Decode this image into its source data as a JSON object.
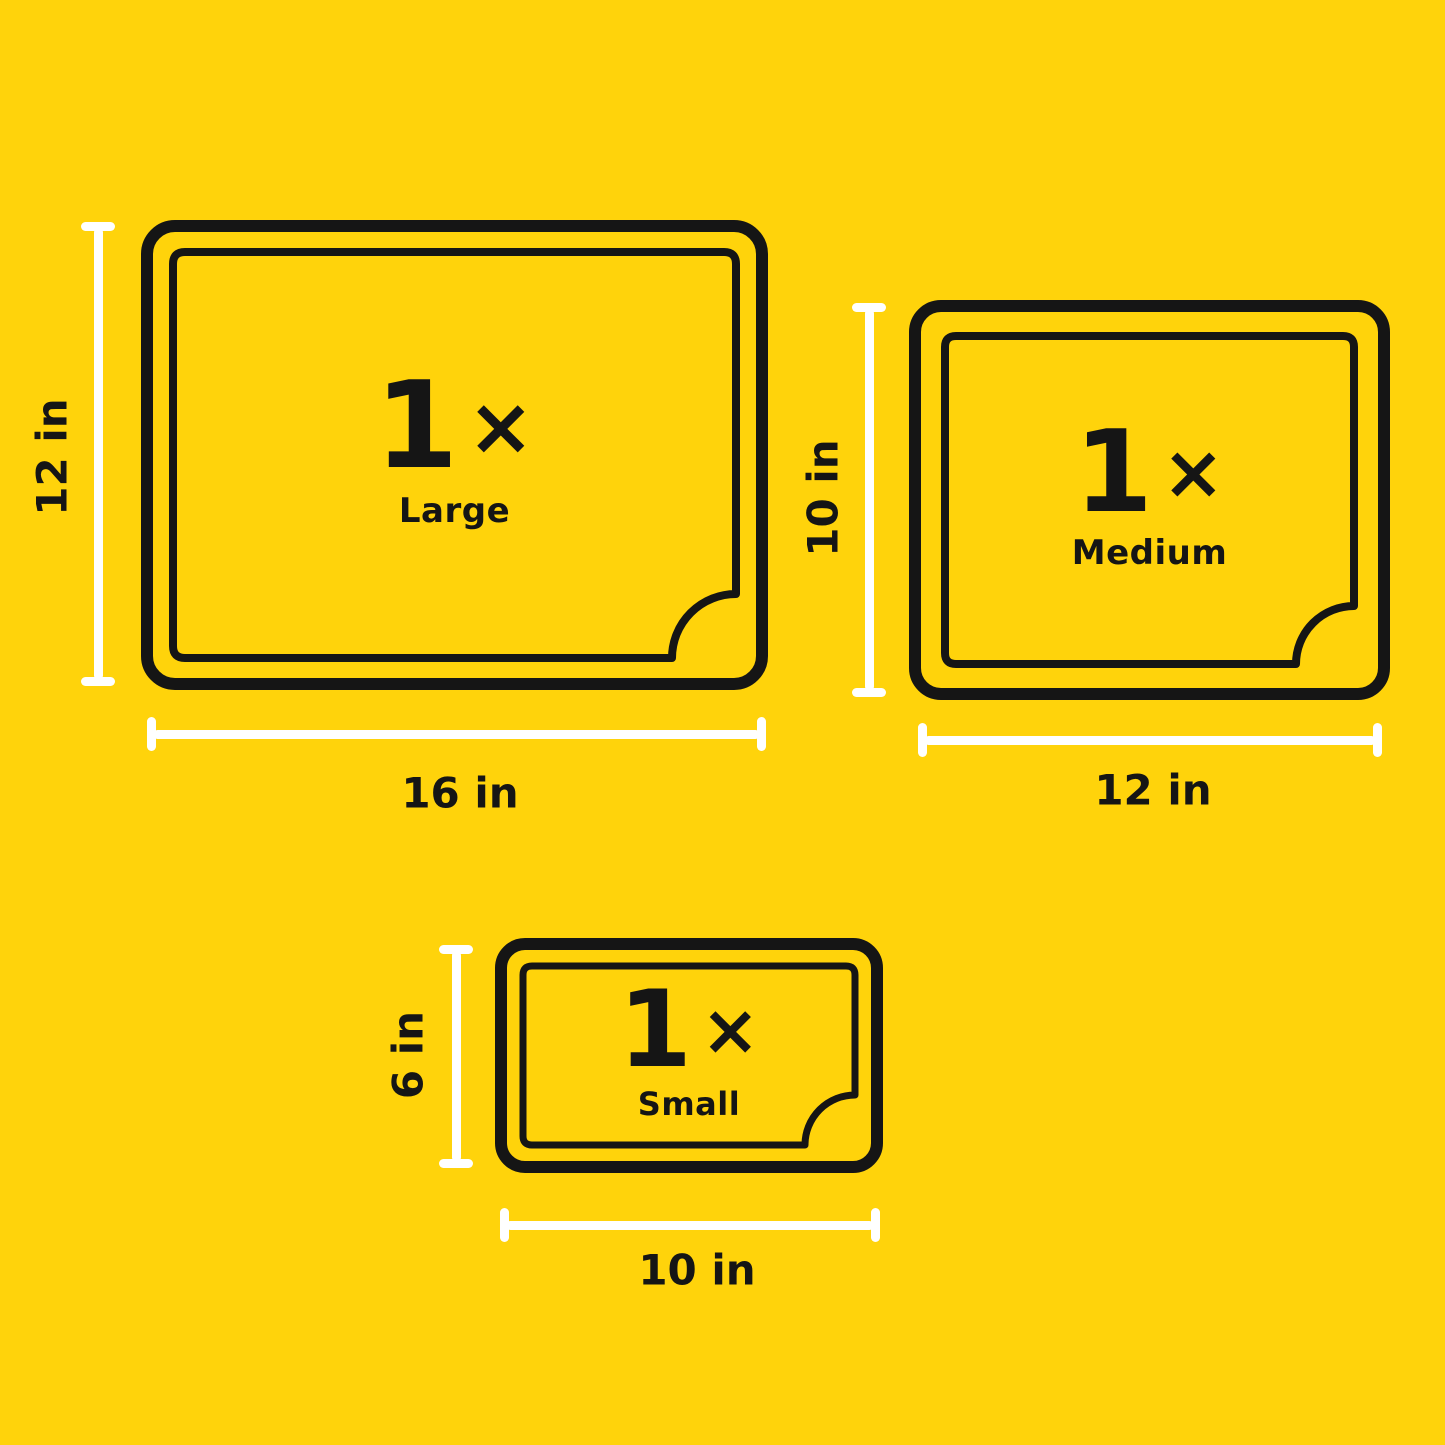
{
  "colors": {
    "background": "#FFD30B",
    "ink": "#151515",
    "dimension_line": "#FFFFFF"
  },
  "items": [
    {
      "id": "large",
      "quantity": "1",
      "multiplier": "×",
      "size_label": "Large",
      "height_label": "12 in",
      "width_label": "16 in"
    },
    {
      "id": "medium",
      "quantity": "1",
      "multiplier": "×",
      "size_label": "Medium",
      "height_label": "10 in",
      "width_label": "12 in"
    },
    {
      "id": "small",
      "quantity": "1",
      "multiplier": "×",
      "size_label": "Small",
      "height_label": "6 in",
      "width_label": "10 in"
    }
  ]
}
